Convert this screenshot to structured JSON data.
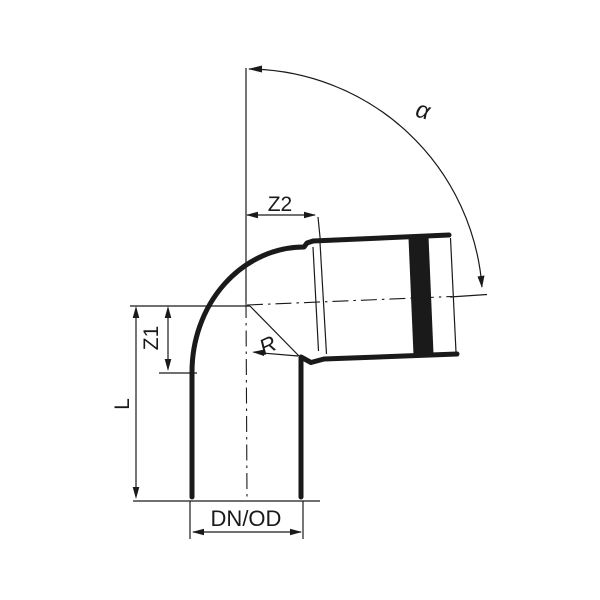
{
  "drawing": {
    "labels": {
      "alpha": "α",
      "z2": "Z2",
      "z1": "Z1",
      "l": "L",
      "r": "R",
      "dn_od": "DN/OD"
    },
    "colors": {
      "line": "#1a1a1a",
      "background": "#ffffff"
    }
  }
}
